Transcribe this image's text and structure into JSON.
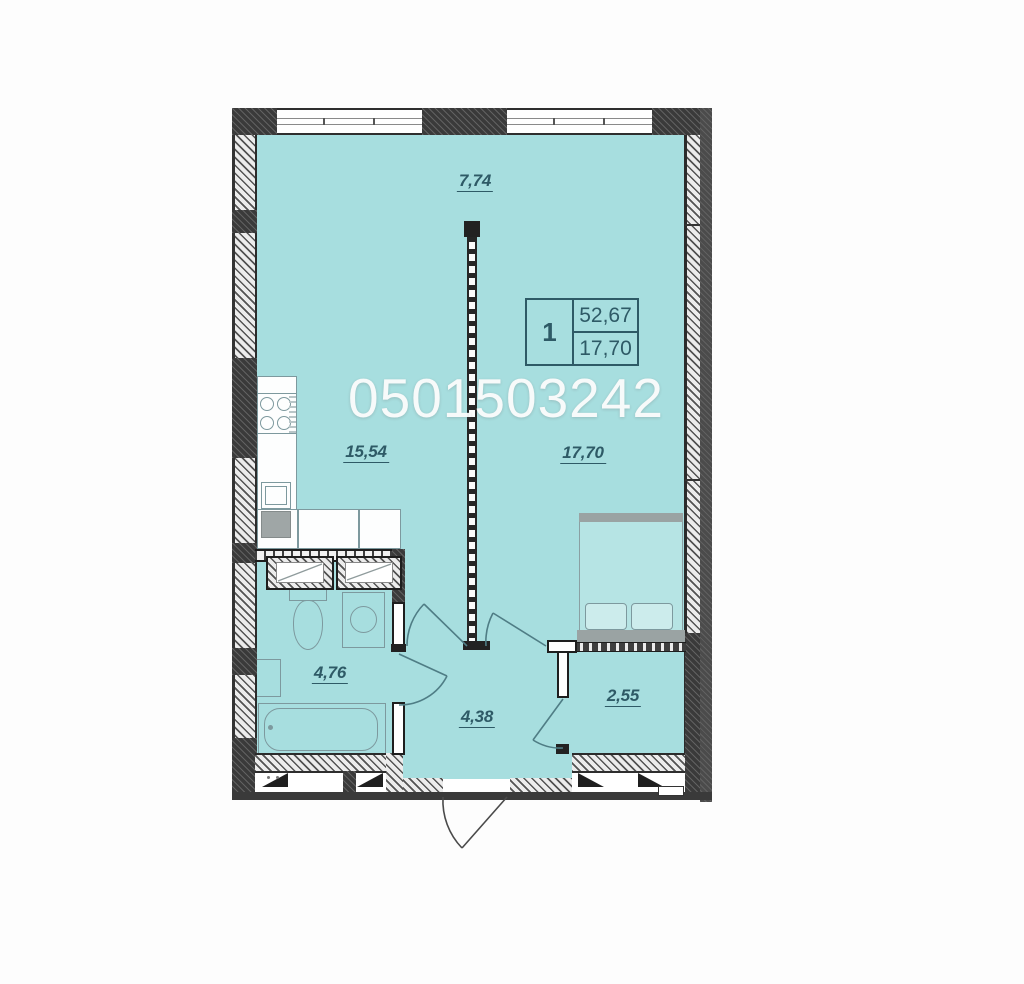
{
  "plan": {
    "type": "apartment-floor-plan",
    "watermark_phone": "0501503242",
    "top_dimension": "7,74",
    "info_box": {
      "room_count": "1",
      "total_area": "52,67",
      "living_area": "17,70"
    },
    "rooms": [
      {
        "name": "kitchen-living-room",
        "area": "15,54"
      },
      {
        "name": "bedroom",
        "area": "17,70"
      },
      {
        "name": "bathroom",
        "area": "4,76"
      },
      {
        "name": "hallway",
        "area": "4,38"
      },
      {
        "name": "wardrobe",
        "area": "2,55"
      }
    ],
    "fixtures": [
      "stove",
      "kitchen-sink",
      "under-counter-appliance",
      "vent-shaft",
      "vent-shaft",
      "toilet",
      "washing-machine",
      "bathroom-sink",
      "bathtub",
      "double-bed"
    ],
    "colors": {
      "floor": "#a7dedf",
      "wall_dark": "#3a3a3a",
      "label": "#2e5a66",
      "fixture_line": "#7d999e",
      "watermark": "#fcfcfc"
    }
  }
}
